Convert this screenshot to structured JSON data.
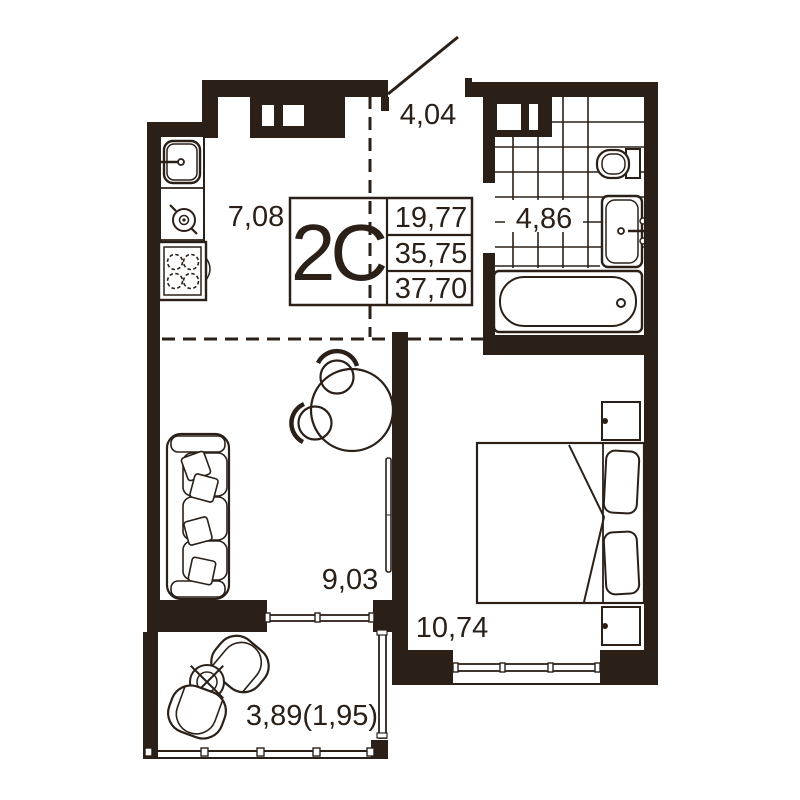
{
  "unit": {
    "label": "2C",
    "stats": [
      "19,77",
      "35,75",
      "37,70"
    ]
  },
  "rooms": {
    "kitchen": "7,08",
    "hallway": "4,04",
    "bathroom": "4,86",
    "living": "9,03",
    "bedroom": "10,74",
    "balcony": "3,89(1,95)"
  },
  "colors": {
    "wall": "#2b2018",
    "paper": "#ffffff"
  }
}
